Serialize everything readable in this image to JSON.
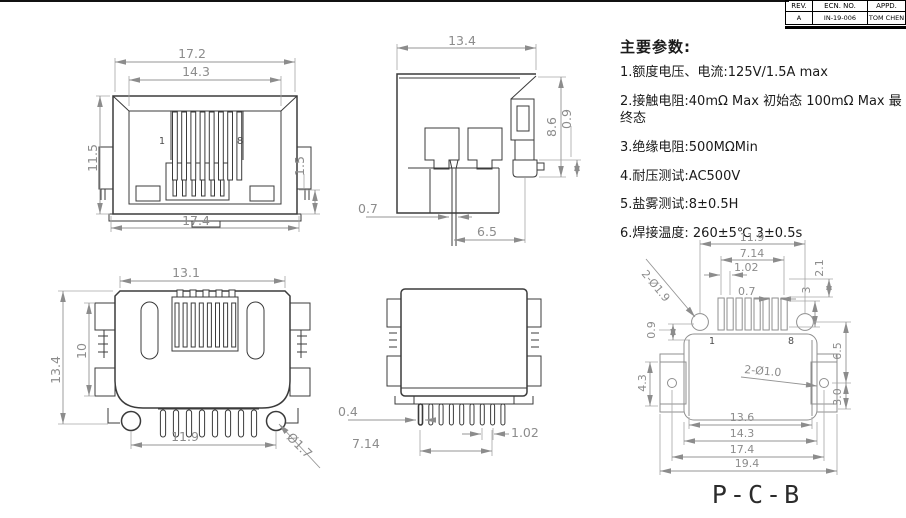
{
  "title_block": {
    "col_rev": "REV.",
    "col_ecn": "ECN. NO.",
    "col_appd": "APPD.",
    "val_rev": "A",
    "val_ecn": "IN-19-006",
    "val_appd": "TOM CHEN"
  },
  "parameters": {
    "title": "主要参数:",
    "item1": "1.额度电压、电流:125V/1.5A max",
    "item2": "2.接触电阻:40mΩ Max 初始态 100mΩ Max 最终态",
    "item3": "3.绝缘电阻:500MΩMin",
    "item4": "4.耐压测试:AC500V",
    "item5": "5.盐雾测试:8±0.5H",
    "item6": "6.焊接温度: 260±5℃ 3±0.5s"
  },
  "front_view": {
    "dim_top_width": "17.2",
    "dim_opening_width": "14.3",
    "dim_height": "11.5",
    "dim_side_tab": "1.5",
    "dim_bottom_width": "17.4",
    "pin_first": "1",
    "pin_last": "8"
  },
  "side_view": {
    "dim_depth": "13.4",
    "dim_height": "8.6",
    "dim_foot": "0.9",
    "dim_pin_width": "0.7",
    "dim_pin_to_peg": "6.5"
  },
  "bottom_view": {
    "dim_body_width": "13.1",
    "dim_total_height": "13.4",
    "dim_body_height": "10",
    "dim_pin_span": "11.9",
    "dim_peg_dia": "Ø1.7"
  },
  "rear_view": {
    "dim_pin_thickness": "0.4",
    "dim_pin_span": "7.14",
    "dim_pin_pitch": "1.02"
  },
  "pcb_view": {
    "title": "P-C-B",
    "dim_hole_span": "11.9",
    "dim_pad_span": "7.14",
    "dim_pad_pitch": "1.02",
    "dim_pad_width": "0.7",
    "dim_pad_len_a": "2.1",
    "dim_pad_len_b": "3",
    "dim_edge_gap": "0.9",
    "dim_hole_to_hole": "6.5",
    "dim_tab_hole_offset": "3.0",
    "dim_tab_height": "4.3",
    "dim_slot_width": "13.6",
    "dim_inner_width": "14.3",
    "dim_tab_hole_span": "17.4",
    "dim_outer_width": "19.4",
    "label_mount_holes": "2-Ø1.9",
    "label_tab_holes": "2-Ø1.0",
    "pin_first": "1",
    "pin_last": "8"
  },
  "colors": {
    "outline": "#3b3b3b",
    "dimension": "#8c8c8c",
    "text": "#1a1a1a"
  }
}
